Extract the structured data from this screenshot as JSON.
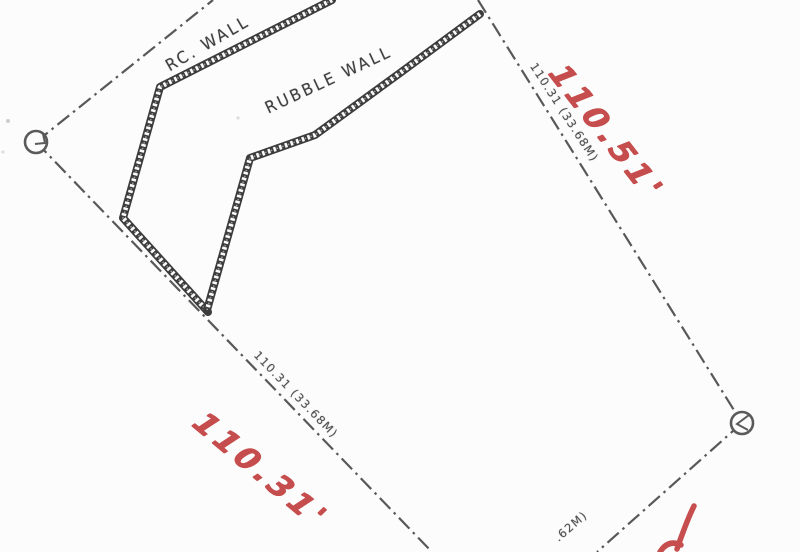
{
  "document": {
    "kind": "scanned survey site plan (cropped)",
    "background_color": "#fcfcfc",
    "ink_color": "#4f4f4f",
    "handwriting_color": "#c24040"
  },
  "wall_labels": {
    "rc_wall": "RC. WALL",
    "rubble_wall": "RUBBLE WALL"
  },
  "printed_dimensions": {
    "right_boundary": "110.31 (33.68M)",
    "bottom_left_boundary": "110.31 (33.68M)",
    "bottom_right_boundary_fragment": ".62M)"
  },
  "handwritten_annotations": {
    "top_right": "110.51'",
    "bottom_left": "110.31'",
    "bottom_right_fragment": "'"
  },
  "markers": {
    "left": "survey boundary marker (circle)",
    "right": "survey boundary marker (circle)"
  }
}
